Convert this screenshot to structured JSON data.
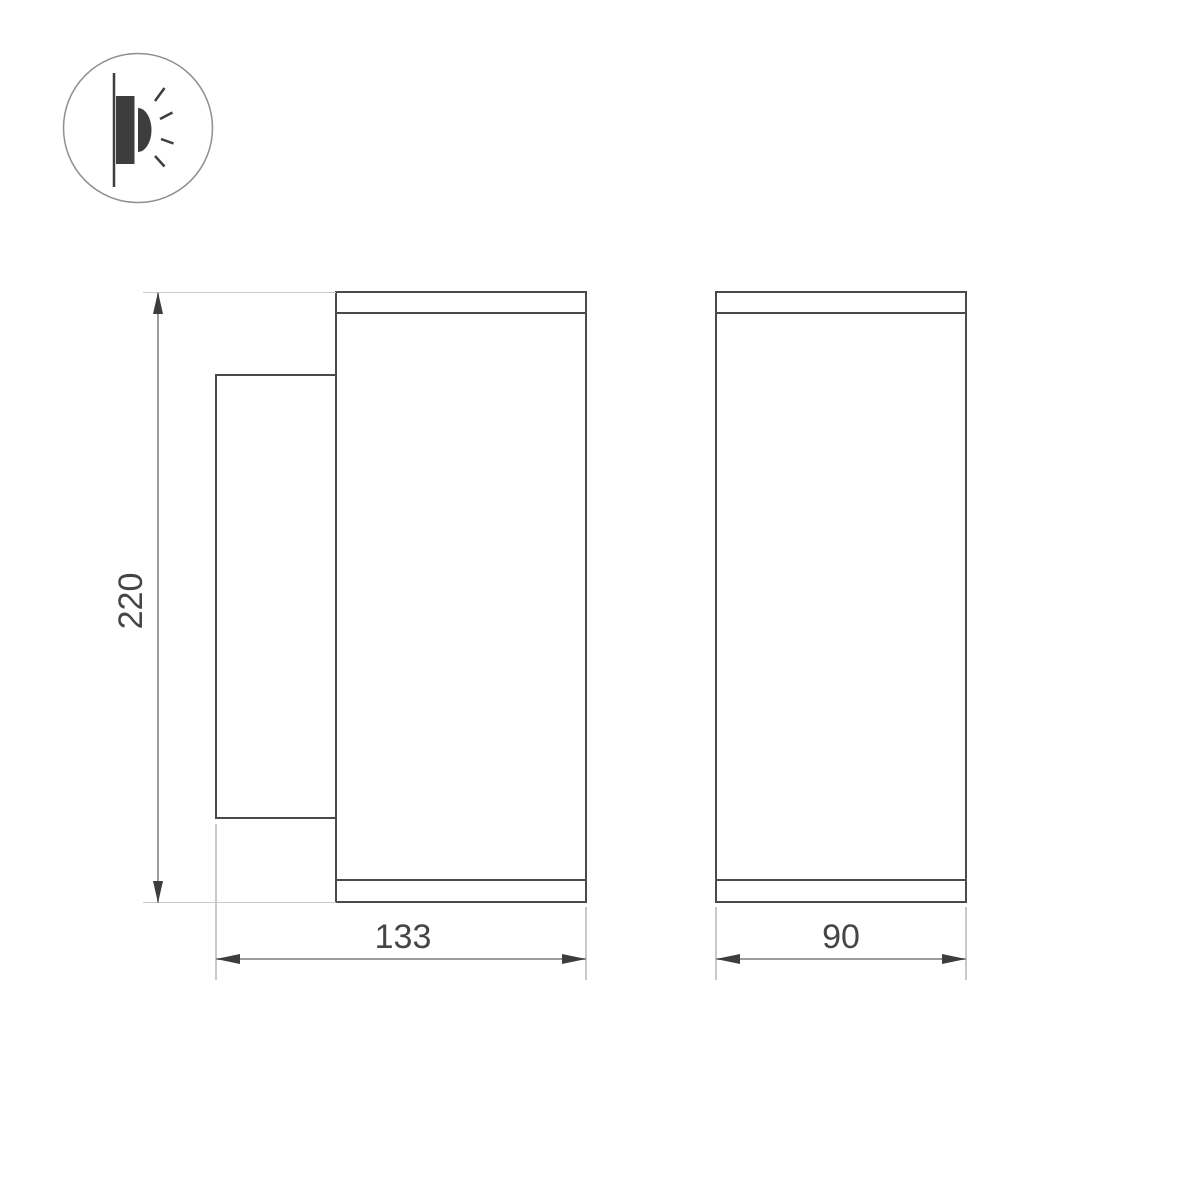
{
  "drawing": {
    "icon": {
      "name": "wall-mounted-light-icon"
    },
    "views": [
      {
        "name": "side-view",
        "description": "side profile with wall-mount plate"
      },
      {
        "name": "front-view",
        "description": "front elevation"
      }
    ],
    "dimensions": {
      "height": {
        "label": "220"
      },
      "depth": {
        "label": "133"
      },
      "width": {
        "label": "90"
      }
    },
    "colors": {
      "background": "#ffffff",
      "outline": "#4a4a4a",
      "dimension_line": "#9c9c9c",
      "extension_line": "#c9c9c9",
      "arrow": "#3d3d3d",
      "text": "#454545",
      "icon_circle": "#8f8f8f",
      "icon_glyph": "#3d3d3d"
    }
  }
}
